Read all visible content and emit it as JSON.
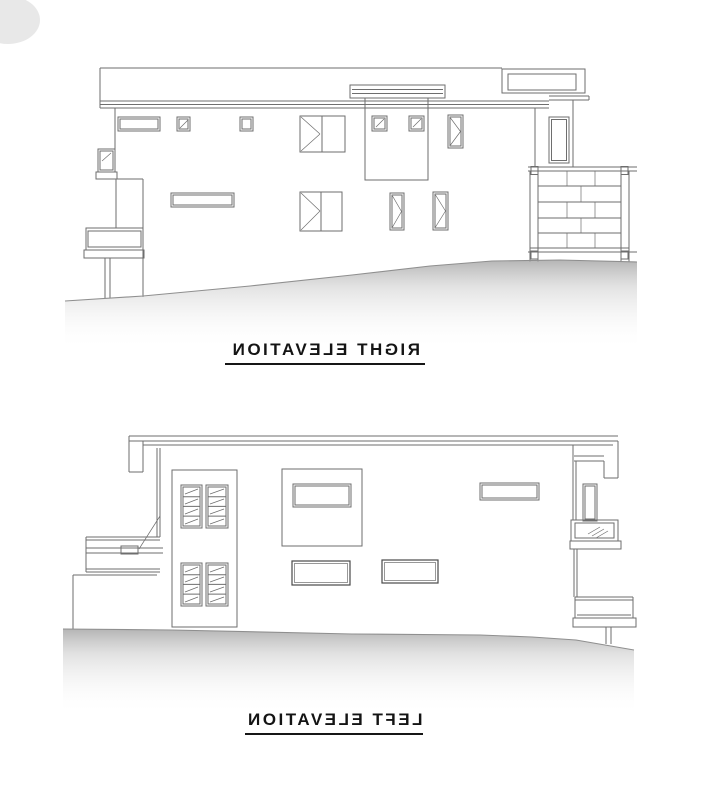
{
  "page": {
    "background": "#ffffff"
  },
  "colors": {
    "line": "#6e6e6e",
    "line_dark": "#4a4a4a",
    "text": "#141414",
    "ground": "#aeaeae"
  },
  "drawings": [
    {
      "label": "RIGHT ELEVATION",
      "text_mirrored": true,
      "underlined": true
    },
    {
      "label": "LEFT ELEVATION",
      "text_mirrored": true,
      "underlined": true
    }
  ]
}
